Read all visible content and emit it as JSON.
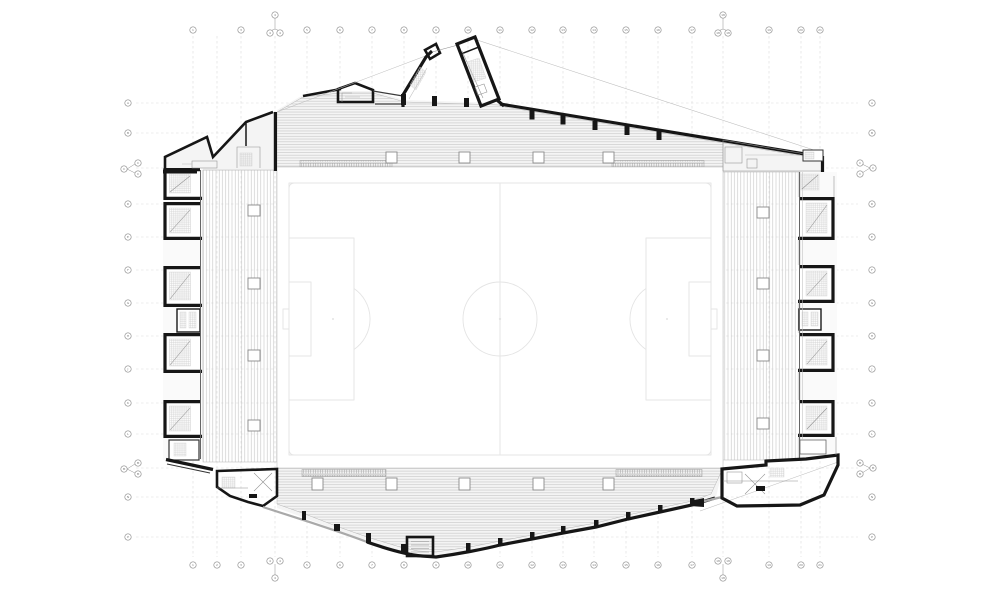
{
  "colors": {
    "wall": "#161616",
    "thin": "#8f8f8f",
    "thin_light": "#bdbdbd",
    "hatch": "#c6c6c6",
    "concourse": "#f4f4f4",
    "band": "#fafafa",
    "pitch_line": "#e4e4e4",
    "grid_line": "#dadada",
    "bubble": "#8f8f8f",
    "gray_wall": "#a9a9a9"
  },
  "grid": {
    "top_labels": [
      "1",
      "2",
      "3",
      "4",
      "5",
      "6",
      "7",
      "8",
      "9",
      "10",
      "11",
      "12",
      "13",
      "14",
      "15",
      "16",
      "17",
      "18",
      "19",
      "20",
      "21"
    ],
    "bottom_labels": [
      "1",
      "2",
      "3",
      "4",
      "5",
      "6",
      "7",
      "8",
      "9",
      "10",
      "11",
      "12",
      "13",
      "14",
      "15",
      "16",
      "17",
      "18",
      "19",
      "20",
      "21"
    ],
    "left_labels": [
      "A",
      "B",
      "C",
      "D",
      "E",
      "F",
      "G",
      "H",
      "J",
      "K",
      "L",
      "M",
      "N",
      "P"
    ],
    "right_labels": [
      "A",
      "B",
      "C",
      "D",
      "E",
      "F",
      "G",
      "H",
      "J",
      "K",
      "L",
      "M",
      "N",
      "P"
    ]
  },
  "pitch": {
    "feature_names": [
      "touchline",
      "halfway-line",
      "centre-circle",
      "centre-spot",
      "penalty-area",
      "goal-area",
      "penalty-arc",
      "penalty-spot",
      "corner-arc",
      "goal"
    ]
  }
}
